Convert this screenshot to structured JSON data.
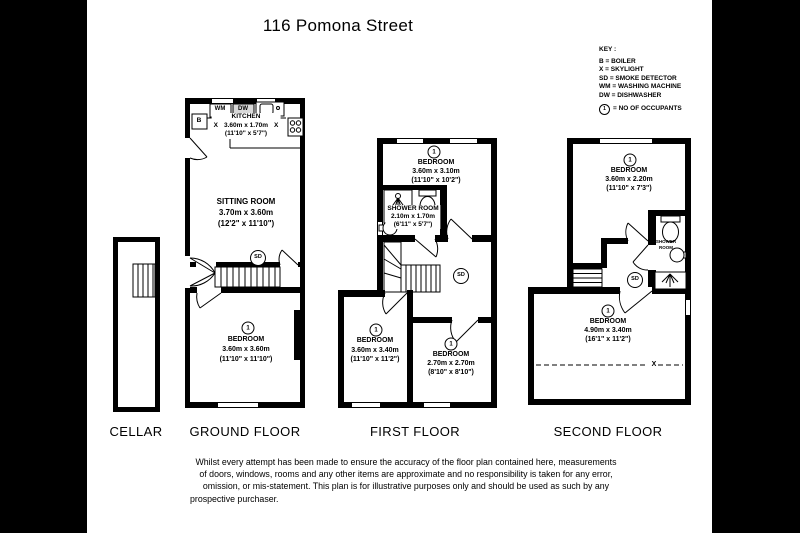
{
  "title": "116 Pomona Street",
  "key": {
    "heading": "KEY :",
    "items": [
      "B = BOILER",
      "X = SKYLIGHT",
      "SD = SMOKE DETECTOR",
      "WM = WASHING MACHINE",
      "DW = DISHWASHER"
    ],
    "occupants_symbol": "1",
    "occupants_label": "= NO OF OCCUPANTS"
  },
  "symbols": {
    "sd": "SD",
    "boiler": "B",
    "washing_machine": "WM",
    "dishwasher": "DW",
    "skylight": "X"
  },
  "floors": {
    "cellar": {
      "label": "CELLAR"
    },
    "ground": {
      "label": "GROUND FLOOR",
      "kitchen": {
        "name": "KITCHEN",
        "metric": "3.60m x 1.70m",
        "imperial": "(11'10\" x 5'7\")"
      },
      "sitting_room": {
        "name": "SITTING ROOM",
        "metric": "3.70m x 3.60m",
        "imperial": "(12'2\" x 11'10\")"
      },
      "bedroom": {
        "occupants": "1",
        "name": "BEDROOM",
        "metric": "3.60m x 3.60m",
        "imperial": "(11'10\" x 11'10\")"
      }
    },
    "first": {
      "label": "FIRST FLOOR",
      "bedroom_top": {
        "occupants": "1",
        "name": "BEDROOM",
        "metric": "3.60m x 3.10m",
        "imperial": "(11'10\" x 10'2\")"
      },
      "shower_room": {
        "name": "SHOWER ROOM",
        "metric": "2.10m x 1.70m",
        "imperial": "(6'11\" x 5'7\")"
      },
      "bedroom_left": {
        "occupants": "1",
        "name": "BEDROOM",
        "metric": "3.60m x 3.40m",
        "imperial": "(11'10\" x 11'2\")"
      },
      "bedroom_right": {
        "occupants": "1",
        "name": "BEDROOM",
        "metric": "2.70m x 2.70m",
        "imperial": "(8'10\" x 8'10\")"
      }
    },
    "second": {
      "label": "SECOND FLOOR",
      "bedroom_top": {
        "occupants": "1",
        "name": "BEDROOM",
        "metric": "3.60m x 2.20m",
        "imperial": "(11'10\" x 7'3\")"
      },
      "shower_room": {
        "name": "SHOWER ROOM"
      },
      "bedroom_bottom": {
        "occupants": "1",
        "name": "BEDROOM",
        "metric": "4.90m x 3.40m",
        "imperial": "(16'1\" x 11'2\")"
      }
    }
  },
  "disclaimer": {
    "lines": [
      "Whilst every attempt has been made to ensure the accuracy of the floor plan contained here, measurements",
      "of doors, windows, rooms and any other items are approximate and no responsibility is taken for any error,",
      "omission, or mis-statement. This plan is for illustrative purposes only and should be used as such by any",
      "prospective purchaser."
    ]
  },
  "colors": {
    "wall": "#000000",
    "paper": "#ffffff",
    "frame": "#000000",
    "dishwasher_fill": "#d9d9d9"
  }
}
